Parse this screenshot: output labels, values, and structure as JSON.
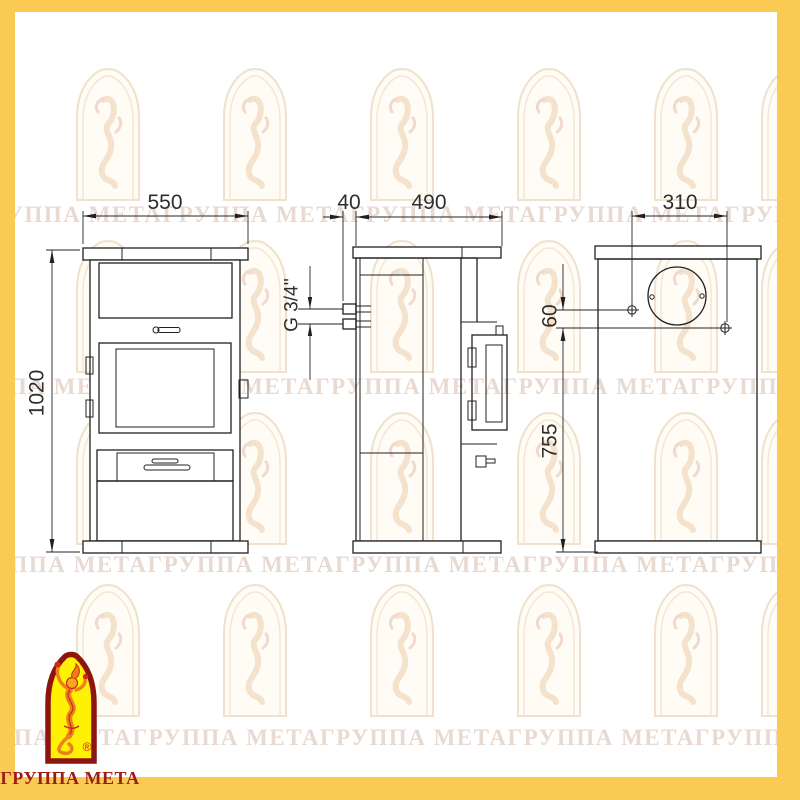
{
  "frame": {
    "border_color": "#fbca52"
  },
  "watermark": {
    "row_text": "ГРУППА МЕТАГРУППА МЕТАГРУППА МЕТАГРУППА МЕТАГРУППА МЕТАГРУППА МЕТА"
  },
  "logo": {
    "caption": "ГРУППА МЕТА",
    "registered_mark": "®",
    "arch_fill": "#fff104",
    "arch_border": "#8e1410",
    "caption_color": "#9e1c18"
  },
  "drawing": {
    "line_color": "#202020",
    "views": {
      "front": "front-view",
      "side": "side-view",
      "back": "back-view"
    },
    "dimensions": {
      "front_width_mm": "550",
      "front_height_mm": "1020",
      "pipe_stub_length_mm": "40",
      "depth_mm": "490",
      "pipe_thread": "G 3/4''",
      "rear_hole_span_mm": "310",
      "rear_hole_offset_mm": "60",
      "rear_hole_height_mm": "755"
    }
  }
}
